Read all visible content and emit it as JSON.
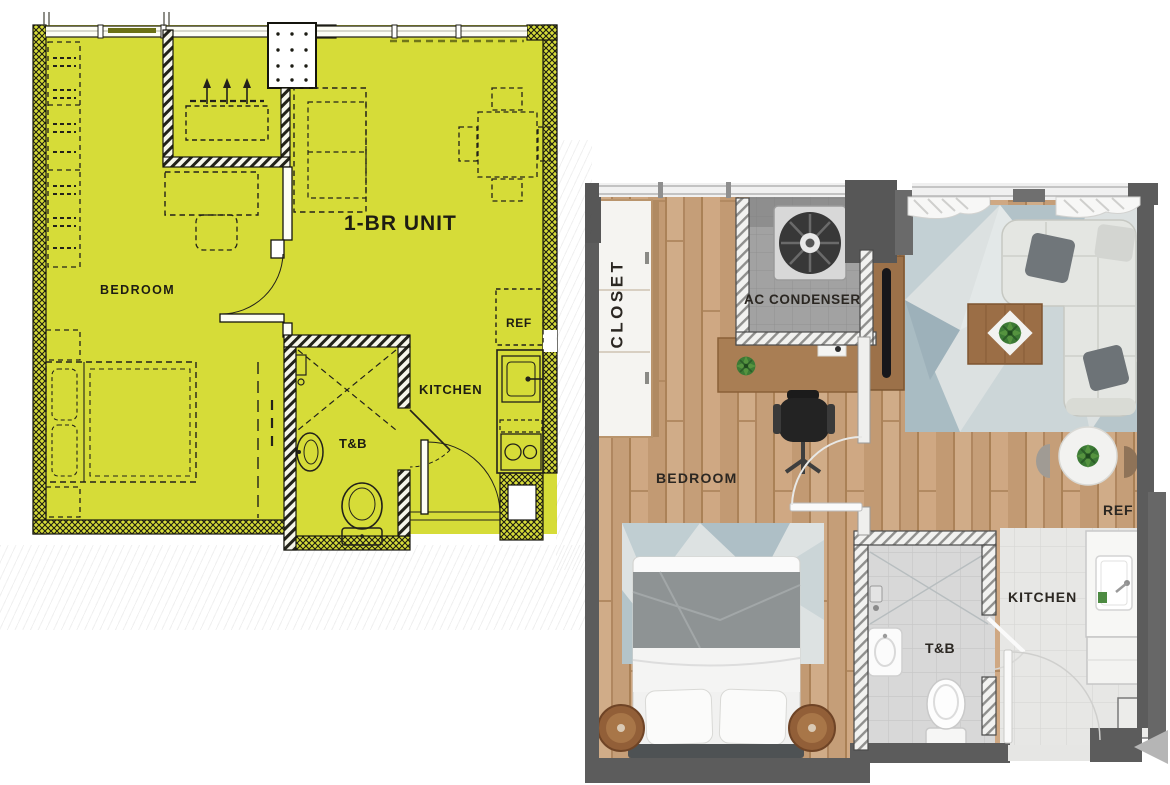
{
  "left_plan": {
    "type": "schematic-floor-plan",
    "unit_type_label": "1-BR UNIT",
    "labels": {
      "bedroom": "BEDROOM",
      "kitchen": "KITCHEN",
      "toilet_bath": "T&B",
      "refrigerator": "REF"
    },
    "colors": {
      "highlight_fill": "#d6dc38",
      "linework": "#22211a"
    }
  },
  "right_plan": {
    "type": "rendered-floor-plan",
    "labels": {
      "closet": "CLOSET",
      "ac_condenser": "AC CONDENSER",
      "bedroom": "BEDROOM",
      "toilet_bath": "T&B",
      "kitchen": "KITCHEN",
      "refrigerator": "REF"
    },
    "colors": {
      "wall": "#5c5c5c",
      "wood_floor": "#c9a37e",
      "bath_tile": "#d8d8d8",
      "kitchen_tile": "#e7e7e5",
      "rug": "#dce1e1"
    }
  }
}
